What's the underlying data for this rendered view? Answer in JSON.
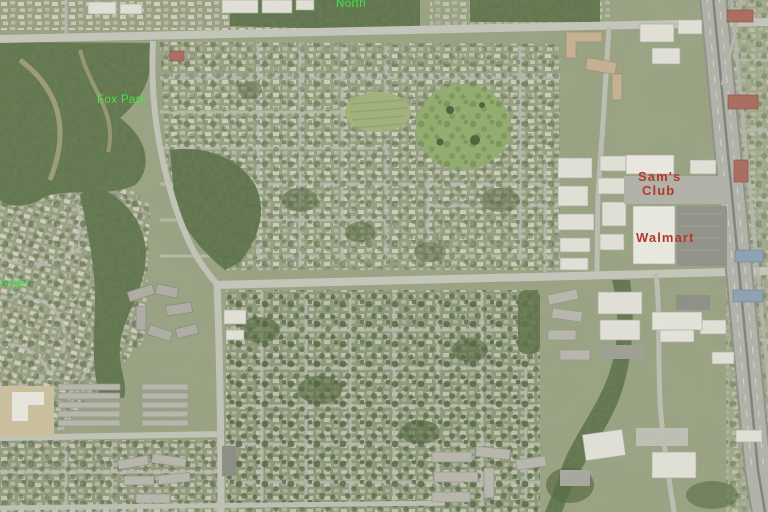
{
  "map": {
    "labels": {
      "north": "North",
      "fox_park": "Fox Park",
      "berger": "berger",
      "sams_club_line1": "Sam's",
      "sams_club_line2": "Club",
      "walmart": "Walmart"
    },
    "colors": {
      "place_label_green": "#44e644",
      "store_label_red": "#b5382c"
    }
  }
}
